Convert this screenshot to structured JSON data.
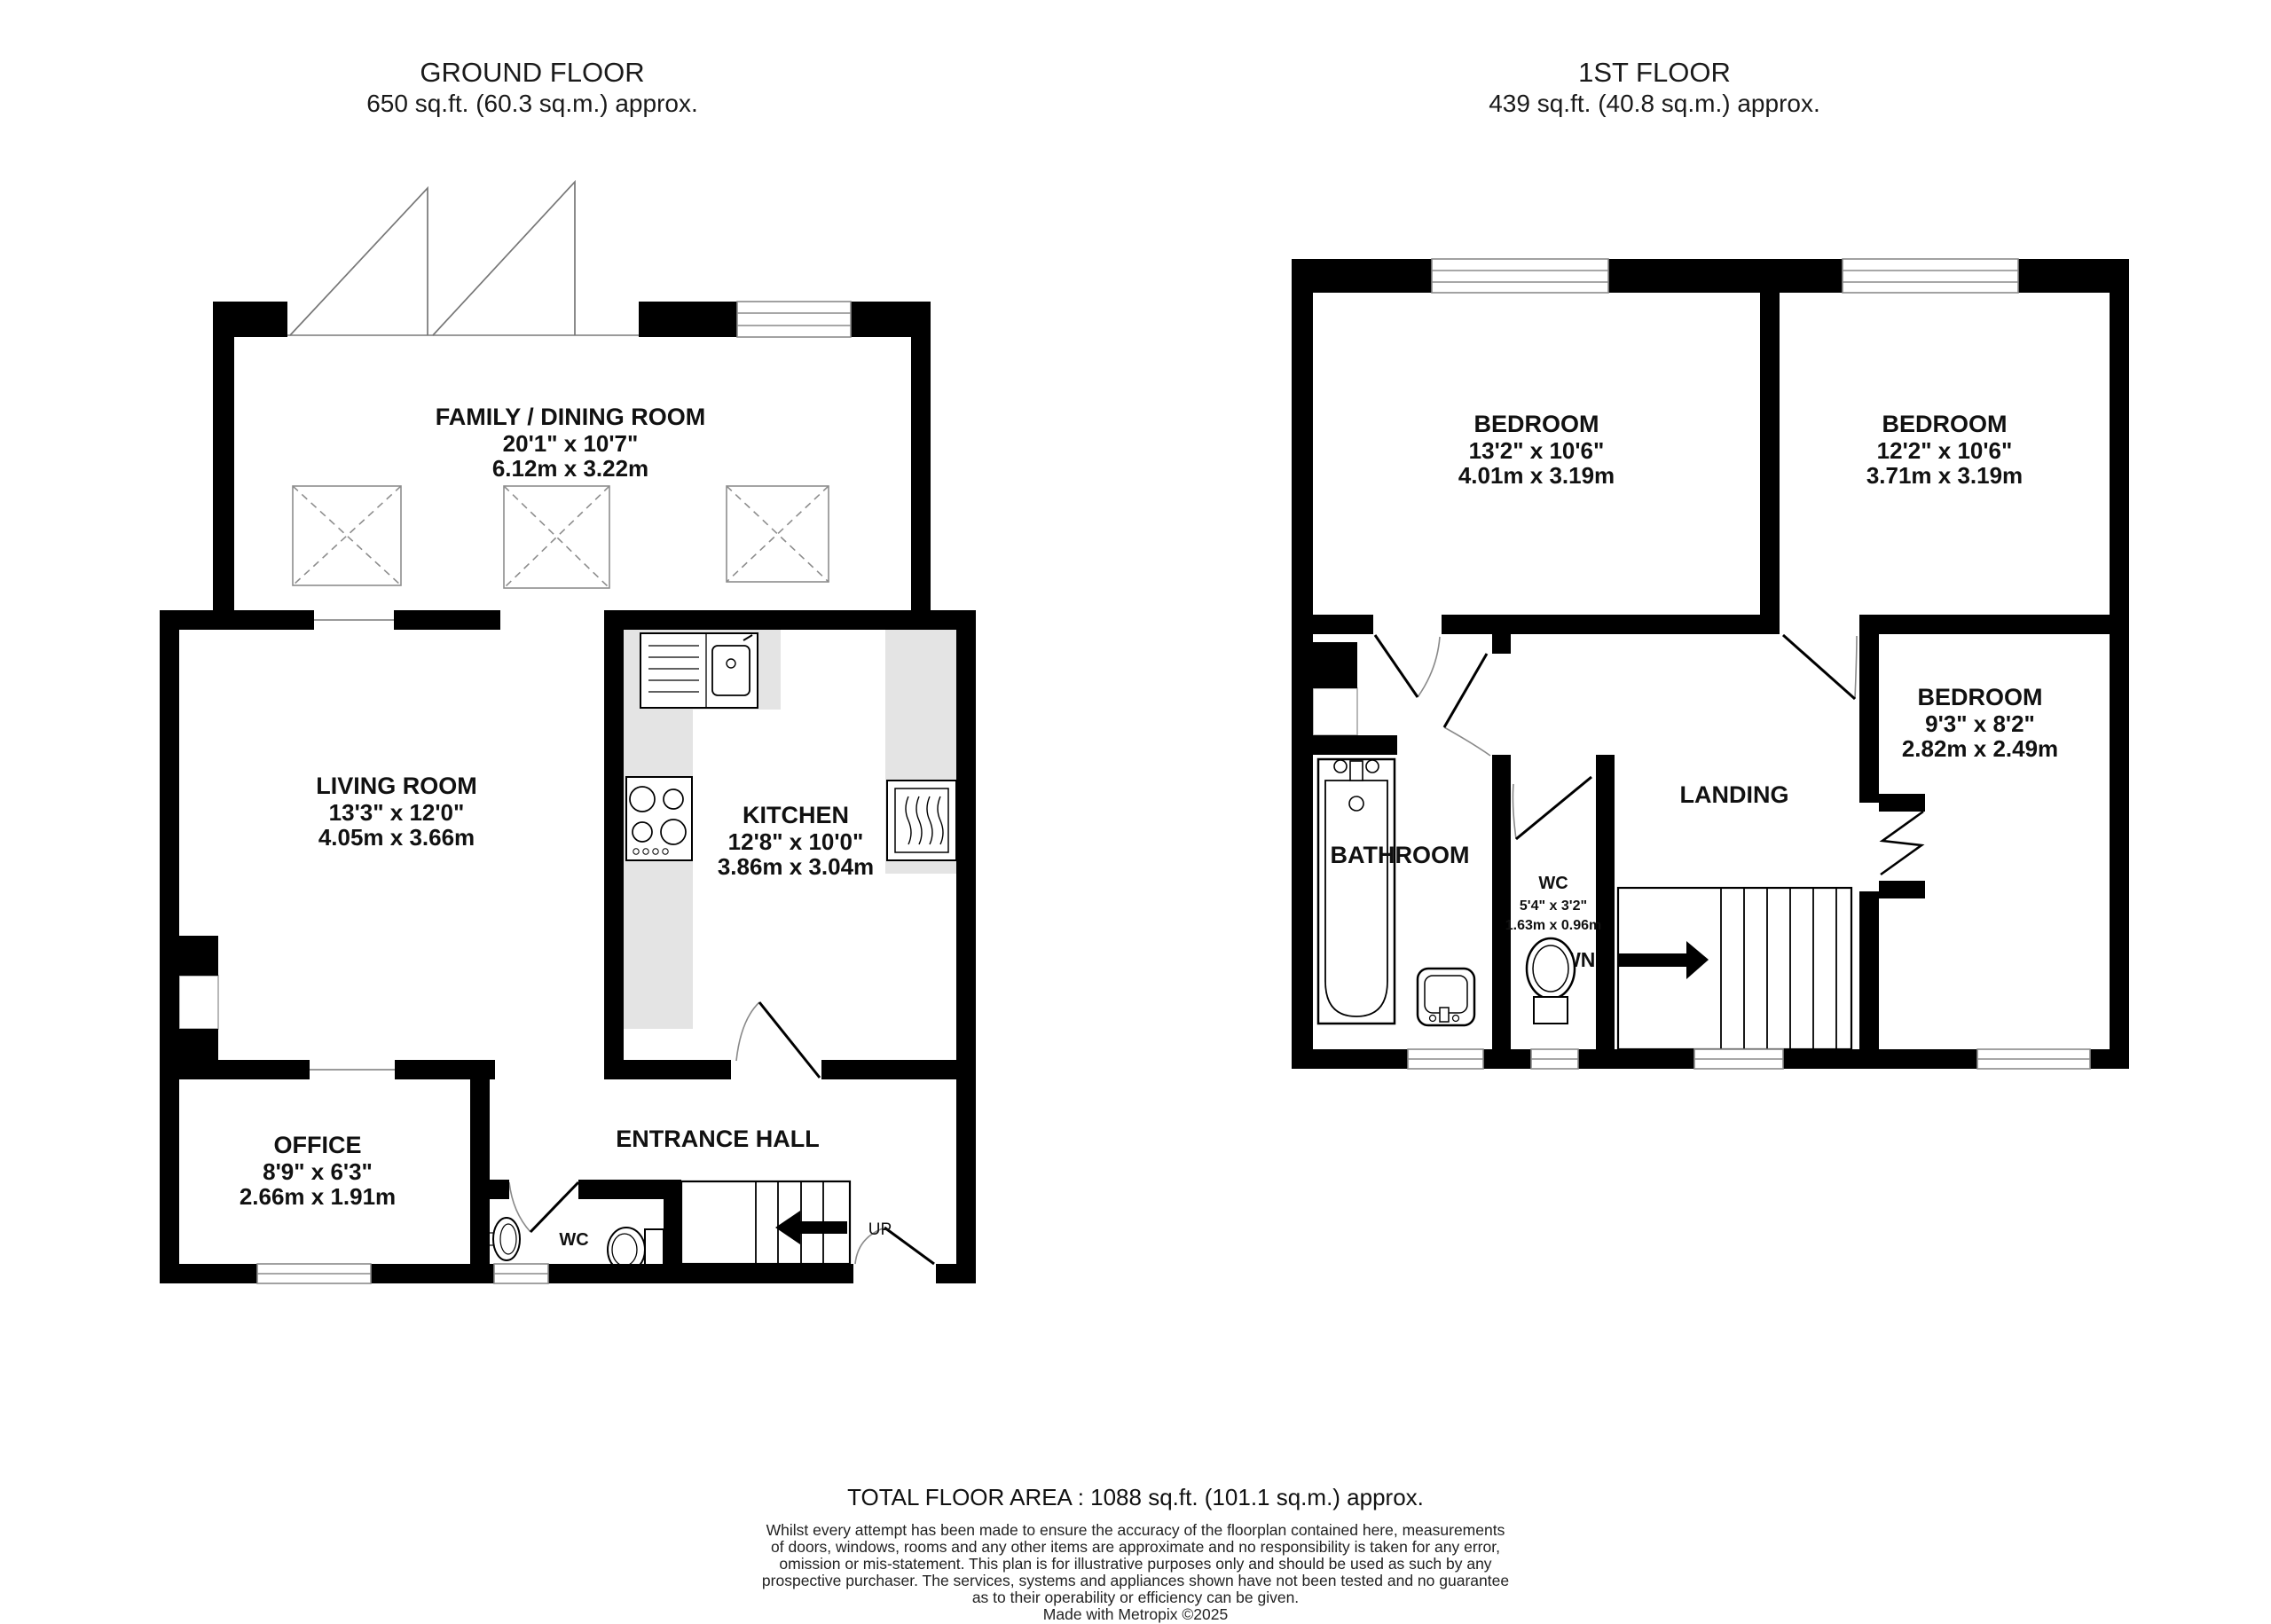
{
  "ground": {
    "title": "GROUND FLOOR",
    "subtitle": "650 sq.ft. (60.3 sq.m.) approx.",
    "rooms": {
      "family": {
        "name": "FAMILY / DINING ROOM",
        "imperial": "20'1\"  x 10'7\"",
        "metric": "6.12m  x 3.22m"
      },
      "living": {
        "name": "LIVING ROOM",
        "imperial": "13'3\"  x 12'0\"",
        "metric": "4.05m  x 3.66m"
      },
      "kitchen": {
        "name": "KITCHEN",
        "imperial": "12'8\"  x 10'0\"",
        "metric": "3.86m  x 3.04m"
      },
      "office": {
        "name": "OFFICE",
        "imperial": "8'9\"  x 6'3\"",
        "metric": "2.66m  x 1.91m"
      }
    },
    "labels": {
      "entrance_hall": "ENTRANCE HALL",
      "wc": "WC",
      "up": "UP"
    }
  },
  "first": {
    "title": "1ST FLOOR",
    "subtitle": "439 sq.ft. (40.8 sq.m.) approx.",
    "rooms": {
      "bedroom1": {
        "name": "BEDROOM",
        "imperial": "13'2\"  x 10'6\"",
        "metric": "4.01m  x 3.19m"
      },
      "bedroom2": {
        "name": "BEDROOM",
        "imperial": "12'2\"  x 10'6\"",
        "metric": "3.71m  x 3.19m"
      },
      "bedroom3": {
        "name": "BEDROOM",
        "imperial": "9'3\"  x 8'2\"",
        "metric": "2.82m  x 2.49m"
      },
      "wc": {
        "name": "WC",
        "imperial": "5'4\"  x 3'2\"",
        "metric": "1.63m  x 0.96m"
      }
    },
    "labels": {
      "bathroom": "BATHROOM",
      "landing": "LANDING",
      "down": "DOWN"
    }
  },
  "footer": {
    "total_area": "TOTAL FLOOR AREA : 1088 sq.ft. (101.1 sq.m.) approx.",
    "disclaimer": [
      "Whilst every attempt has been made to ensure the accuracy of the floorplan contained here, measurements",
      "of doors, windows, rooms and any other items are approximate and no responsibility is taken for any error,",
      "omission or mis-statement. This plan is for illustrative purposes only and should be used as such by any",
      "prospective purchaser. The services, systems and appliances shown have not been tested and no guarantee",
      "as to their operability or efficiency can be given."
    ],
    "credit": "Made with Metropix ©2025"
  },
  "colors": {
    "wall": "#000000",
    "counter": "#e4e4e4",
    "window_frame": "#8a8a8a"
  }
}
